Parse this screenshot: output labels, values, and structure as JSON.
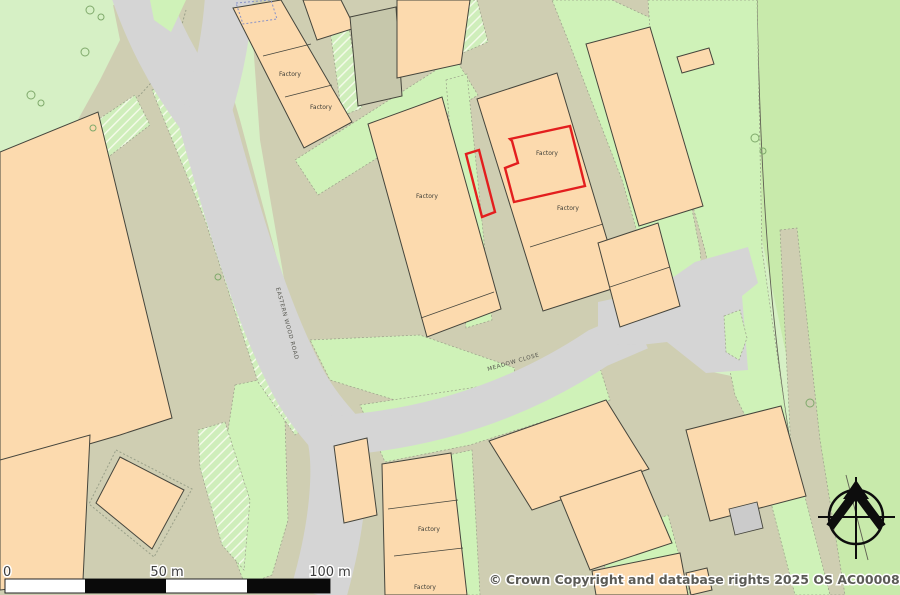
{
  "map": {
    "labels": {
      "factory": "Factory",
      "road_eastern_wood": "EASTERN WOOD ROAD",
      "road_meadow_close": "MEADOW CLOSE"
    },
    "scale_bar": {
      "zero": "0",
      "fifty": "50 m",
      "hundred": "100 m"
    },
    "copyright": "© Crown Copyright and database rights 2025 OS AC0000829429",
    "colors": {
      "field-base": "#d6f0c5",
      "field-east": "#c8eaab",
      "green-strip": "#cff2b8",
      "land": "#cfceb2",
      "road": "#d5d5d5",
      "building": "#fcdaae",
      "building-grey": "#c6c7ab",
      "building-outline": "#45453c",
      "plot-red": "#e31e1e",
      "hatch-base": "#cfeebb",
      "dash-border": "#9aa089",
      "boundary": "#5f5f52",
      "text": "#3f3f38"
    }
  }
}
